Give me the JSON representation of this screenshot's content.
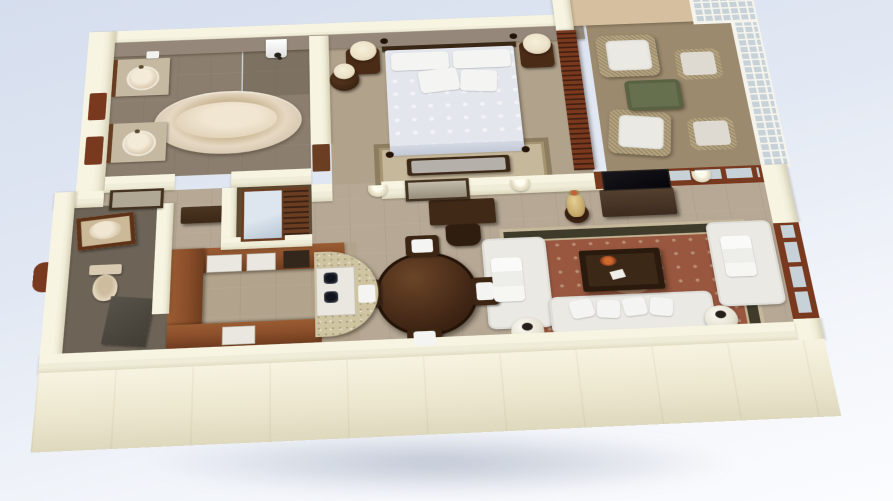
{
  "meta": {
    "title": "3D isometric floor-plan rendering of a one-bedroom hotel suite",
    "style": "photorealistic architectural cutaway model viewed from above at an angle",
    "background": "pale blue studio backdrop with soft shadow beneath the model",
    "visible_text": "none"
  },
  "palette": {
    "sky1": "#d5deee",
    "sky2": "#f2f5fa",
    "wallCream": "#efecd8",
    "wallCap": "#f7f4e2",
    "wallInner": "#95887a",
    "wallTan": "#d6bf9f",
    "floorBath": "#8b7e6e",
    "floorBed": "#b1a28c",
    "floorLiving": "#b6a894",
    "floorSun": "#9c8a6e",
    "floorPowder": "#6d6457",
    "floorKitchen": "#b2a38c",
    "floorCloset": "#5f4b33",
    "woodDark": "#3c2817",
    "woodMid": "#6b3e22",
    "woodRed": "#79391e",
    "woodKitchen": "#8a4e2a",
    "granite": "#cfc4a2",
    "marble": "#c6b9a2",
    "white": "#eae9e4",
    "cushion": "#f4f4f2",
    "bedSpread": "#e3e6ed",
    "rugRed": "#99573f",
    "rugBorder": "#3e3b2b",
    "rugBeige": "#c6b89b",
    "tub": "#e6d8c2",
    "green": "#67704e",
    "glass": "#c7d1d8",
    "mirror": "#dde6ee",
    "lamp": "#ece2c8",
    "shadow": "#8c98b4"
  },
  "rooms": [
    {
      "id": "master-bathroom",
      "label": "Master bathroom",
      "furniture": [
        "oval soaking tub",
        "two marble vanities with round sinks",
        "walk-in shower with shower head",
        "white towels"
      ]
    },
    {
      "id": "master-bedroom",
      "label": "Master bedroom",
      "furniture": [
        "bed with white damask spread and four white pillows",
        "dark wood headboard with posts",
        "two nightstands with cream lamps",
        "round side table with lamp",
        "upholstered foot bench",
        "beige area rug",
        "carved wood folding screen"
      ]
    },
    {
      "id": "sunroom",
      "label": "Sunroom / lanai",
      "furniture": [
        "two wicker armchairs with white cushions",
        "two wicker ottomans",
        "green cushioned bench",
        "white lattice windows",
        "tan feature wall"
      ]
    },
    {
      "id": "hallway",
      "label": "Hallway / gallery wall",
      "furniture": [
        "framed artwork",
        "arched wall sconces",
        "dark writing desk with chair",
        "decorative amber urn on stand"
      ]
    },
    {
      "id": "living-room",
      "label": "Living room",
      "furniture": [
        "flat-panel TV on dark console",
        "three white sofas with throw pillows",
        "dark wood coffee table with orange flowers and magazines",
        "red oriental rug with dark border",
        "two white sphere table lamps",
        "french doors to sunroom and terrace"
      ]
    },
    {
      "id": "dining-area",
      "label": "Dining area",
      "furniture": [
        "round dark wood dining table",
        "four dark wood chairs with white seat cushions"
      ]
    },
    {
      "id": "kitchen",
      "label": "Kitchen",
      "furniture": [
        "L-shaped warm wood cabinetry",
        "white built-in appliances",
        "curved granite breakfast bar",
        "two-burner cooktop"
      ]
    },
    {
      "id": "powder-room",
      "label": "Powder room",
      "furniture": [
        "wood-framed vanity with oval sink",
        "toilet",
        "dark slate floor"
      ]
    },
    {
      "id": "dressing-area",
      "label": "Dressing area / closet",
      "furniture": [
        "full-length mirror in wood frame",
        "louvered wood shelving",
        "entry console table",
        "red entry door arch"
      ]
    }
  ]
}
